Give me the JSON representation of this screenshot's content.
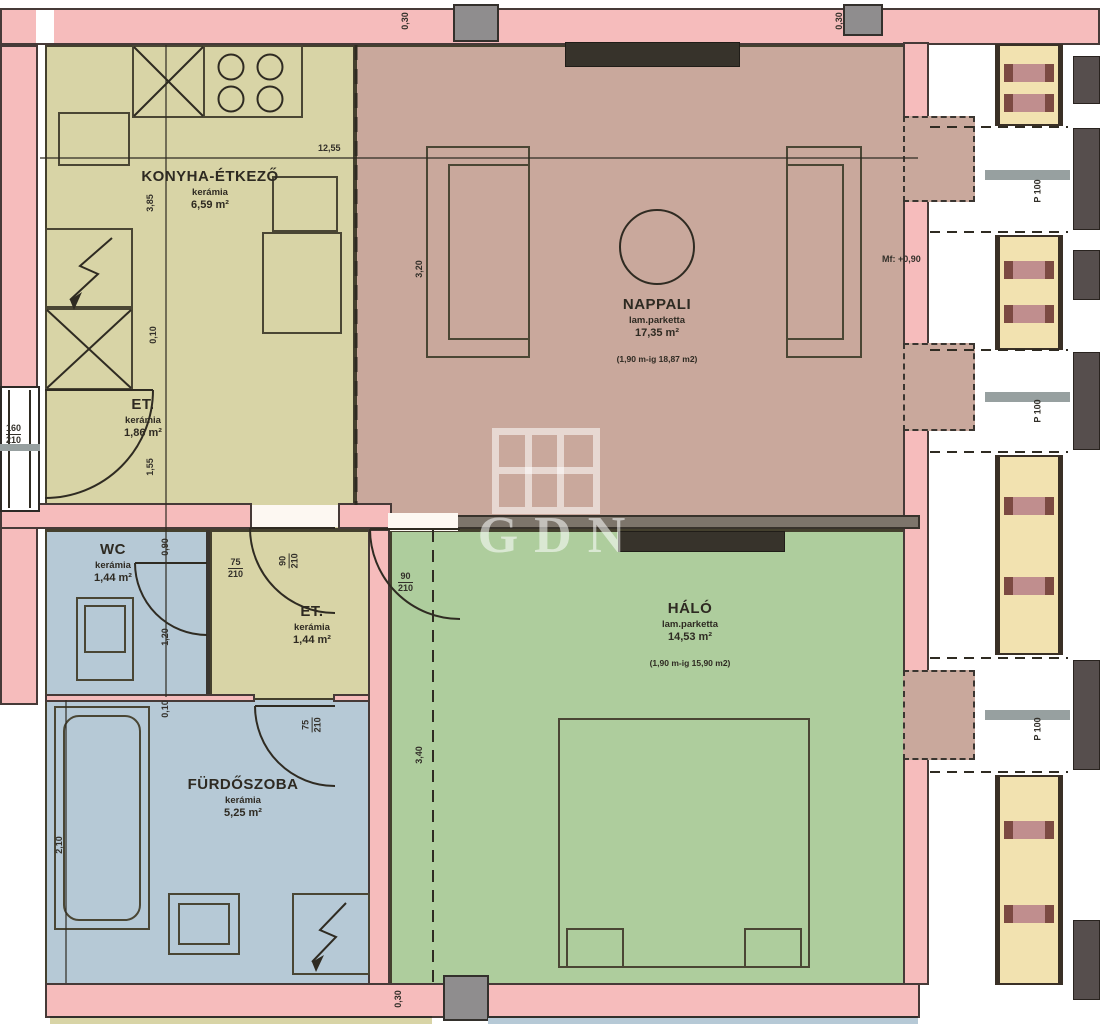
{
  "plan": {
    "watermark": "GDN",
    "rooms": {
      "kitchen": {
        "name": "KONYHA-ÉTKEZŐ",
        "floor": "kerámia",
        "area": "6,59 m²"
      },
      "entry_left": {
        "name": "ET.",
        "floor": "kerámia",
        "area": "1,86 m²"
      },
      "living": {
        "name": "NAPPALI",
        "floor": "lam.parketta",
        "area": "17,35 m²",
        "note": "(1,90 m-ig 18,87 m2)"
      },
      "bedroom": {
        "name": "HÁLÓ",
        "floor": "lam.parketta",
        "area": "14,53 m²",
        "note": "(1,90 m-ig 15,90 m2)"
      },
      "wc": {
        "name": "WC",
        "floor": "kerámia",
        "area": "1,44 m²"
      },
      "entry_mid": {
        "name": "ET.",
        "floor": "kerámia",
        "area": "1,44 m²"
      },
      "bathroom": {
        "name": "FÜRDŐSZOBA",
        "floor": "kerámia",
        "area": "5,25 m²"
      }
    },
    "dims": {
      "total": "12,55",
      "wall": "0,30",
      "k1": "3,85",
      "k2": "0,10",
      "k3": "1,55",
      "wc1": "0,90",
      "wc2": "1,20",
      "ba1": "0,10",
      "ba2": "2,10",
      "bed1": "3,40",
      "liv1": "3,20",
      "level": "Mf: +0,90",
      "parapet": "P 100"
    },
    "doors": {
      "wc": {
        "w": "75",
        "h": "210"
      },
      "entry_mid": {
        "w": "90",
        "h": "210"
      },
      "bedroom": {
        "w": "90",
        "h": "210"
      },
      "bathroom": {
        "w": "75",
        "h": "210"
      },
      "window_left": {
        "w": "160",
        "h": "210"
      }
    },
    "colors": {
      "wall_pink": "#f6bcbc",
      "kitchen_olive": "#d8d4a6",
      "living_mauve": "#c9a89c",
      "bedroom_green": "#aecd9d",
      "bath_blue": "#b6c9d6",
      "outline": "#3a342c",
      "column_gray": "#8f8d8e",
      "cream": "#f2e2b0",
      "band_rose": "#c08e8e",
      "dark": "#564e4d"
    }
  }
}
